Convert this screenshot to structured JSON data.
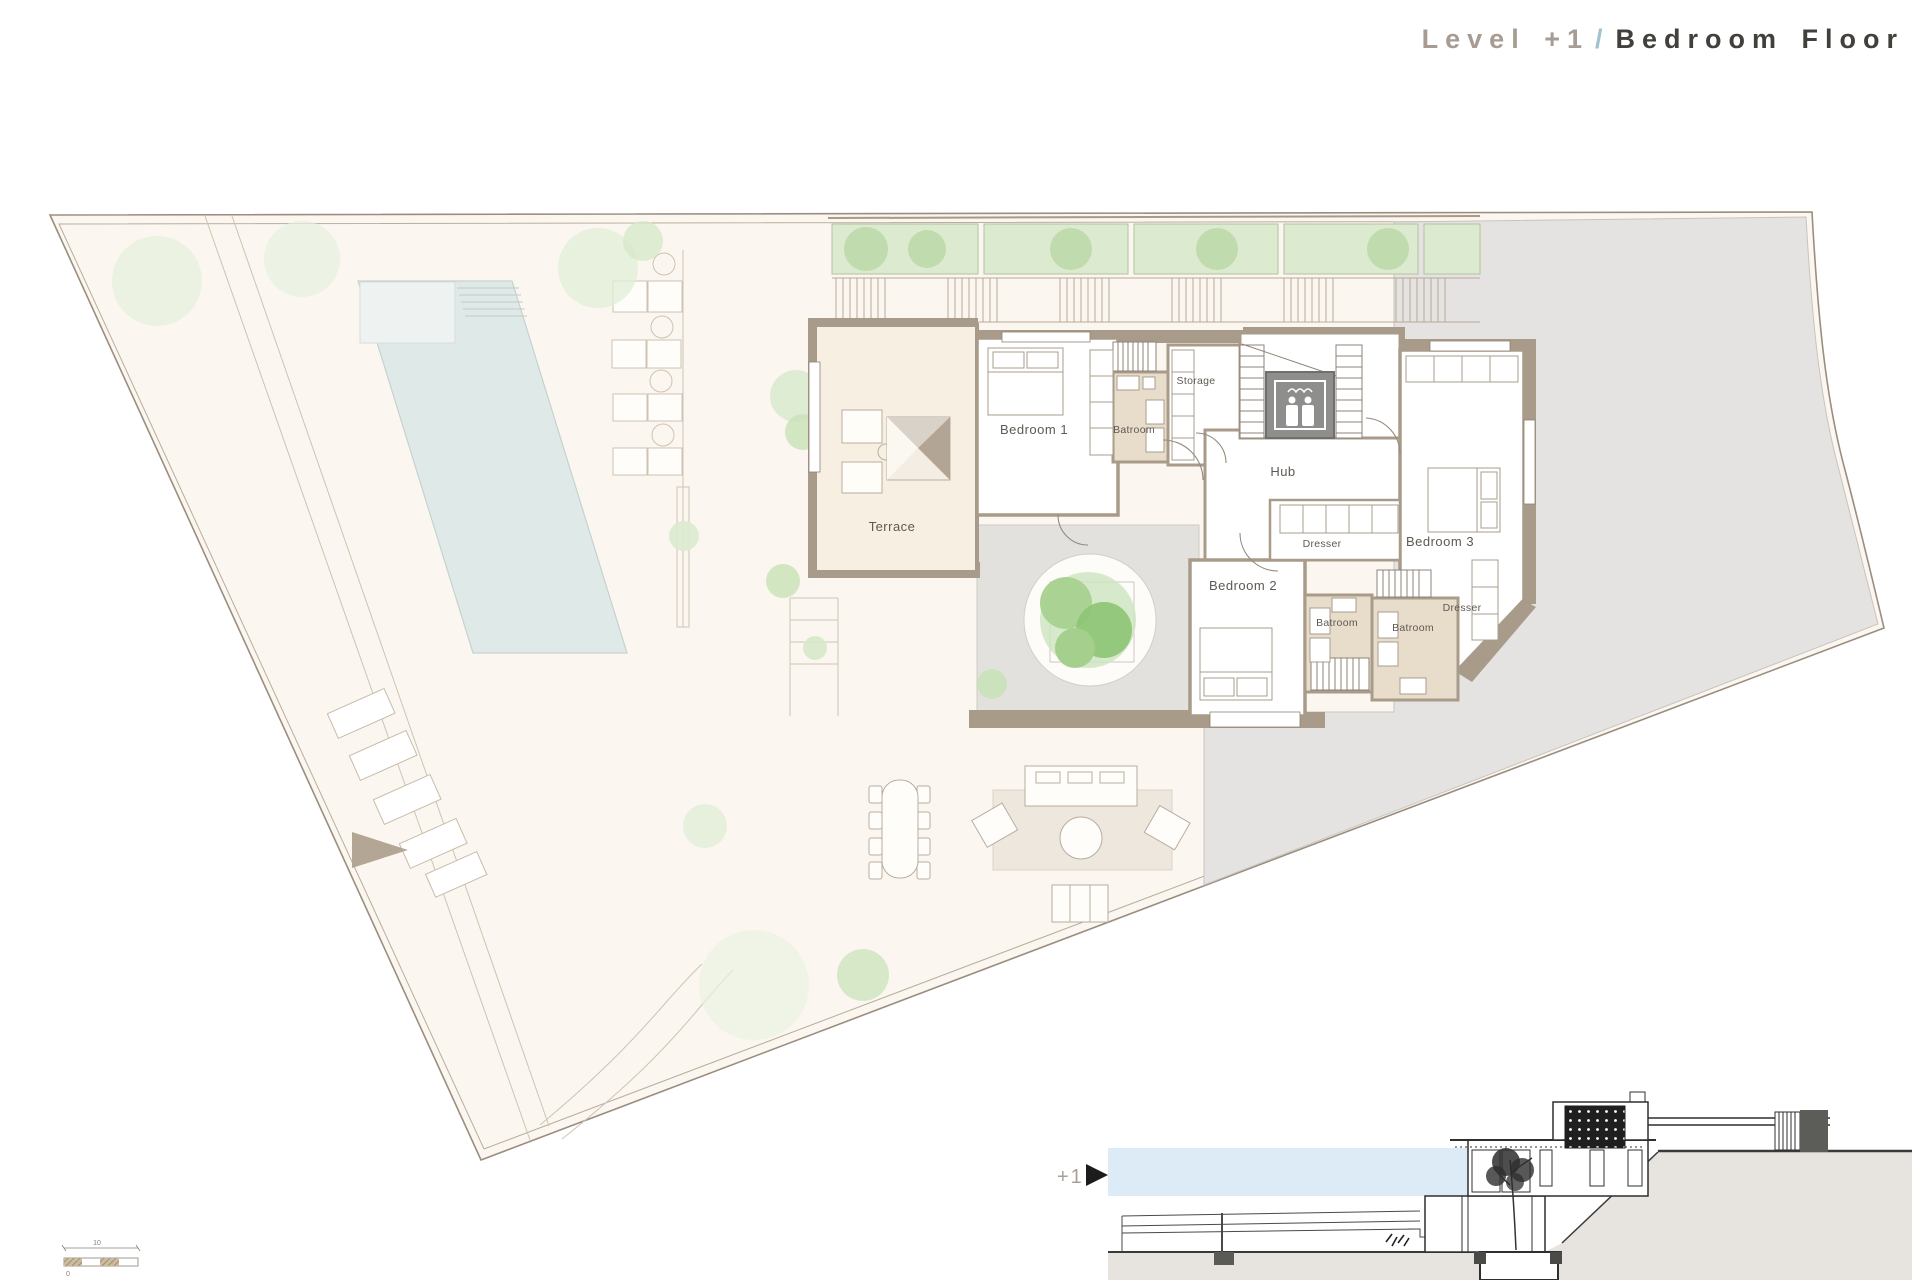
{
  "title": {
    "level": "Level +1",
    "separator": "/",
    "floor": "Bedroom Floor"
  },
  "plan_labels": {
    "terrace": "Terrace",
    "bedroom1": "Bedroom 1",
    "bathroom1": "Batroom",
    "storage": "Storage",
    "hub": "Hub",
    "dresser1": "Dresser",
    "bedroom2": "Bedroom 2",
    "bathroom2": "Batroom",
    "bathroom3": "Batroom",
    "dresser2": "Dresser",
    "bedroom3": "Bedroom 3"
  },
  "section": {
    "marker": "+1",
    "arrow": "►"
  },
  "scalebar": {
    "length_label": "10",
    "zero_label": "0"
  },
  "icons": [
    "elevator-people-icon",
    "level-arrow-icon",
    "skylight-pyramid",
    "courtyard-tree"
  ],
  "colors": {
    "site_fill": "#fbf7f0",
    "boundary_line": "#9b8d7f",
    "neighbor_gray": "#e4e3e1",
    "pool_water": "#dfe9e8",
    "pool_shelf": "#eef3f1",
    "planter_green": "#dcead0",
    "shrub_green": "#bcd9a8",
    "wall_taupe": "#a99b89",
    "bathroom_floor": "#e8dccb",
    "terrace_floor": "#f8efe3",
    "courtyard_gray": "#e2e1de",
    "elevator_gray": "#8e8e8c",
    "rug_beige": "#eee7de",
    "section_blue_band": "#ddebf6",
    "section_ground": "#e7e4df",
    "title_gray": "#a69c94",
    "title_blue": "#9fc3d2",
    "title_dark": "#42403c"
  }
}
